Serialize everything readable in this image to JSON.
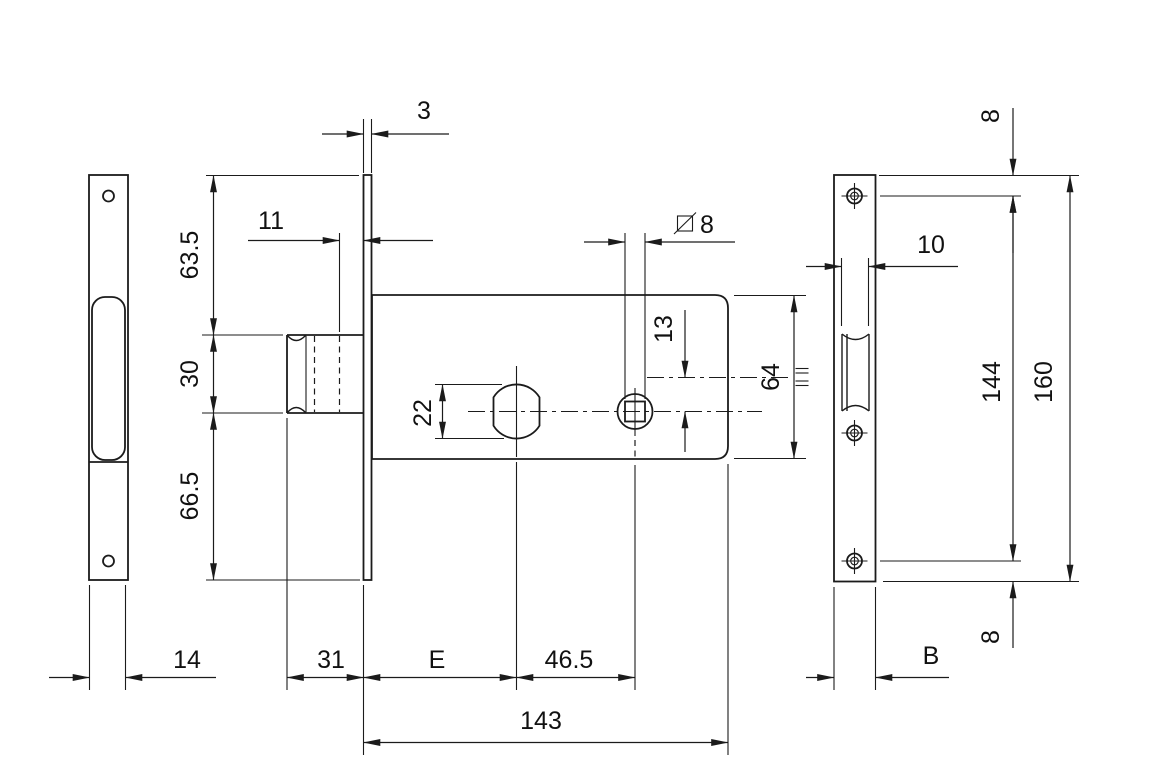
{
  "labels": {
    "plate_thickness": "3",
    "cylinder_inset": "11",
    "top_section": "63.5",
    "tube_diameter": "30",
    "bottom_section": "66.5",
    "cylinder_hole": "22",
    "spindle_offset": "13",
    "spindle_square": "8",
    "case_height": "64",
    "channel_width": "10",
    "edge_to_hole_top": "8",
    "hole_spacing": "144",
    "plate_height": "160",
    "left_plate_width": "14",
    "tube_length": "31",
    "backset": "E",
    "cylinder_to_spindle": "46.5",
    "case_length": "143",
    "right_plate_width": "B",
    "edge_to_hole_bottom": "8"
  }
}
